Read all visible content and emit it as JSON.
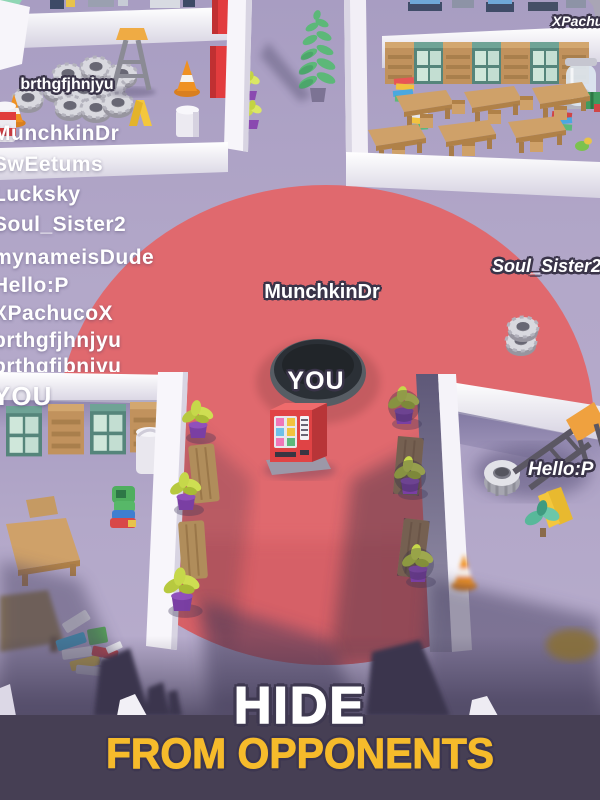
{
  "game": {
    "banner": {
      "title": "HIDE",
      "subtitle": "FROM OPPONENTS"
    },
    "players": {
      "list": [
        "MunchkinDr",
        "SwEetums",
        "Lucksky",
        "Soul_Sister2",
        "mynameisDude",
        "Hello:P",
        "XPachucoX",
        "brthgfjhnjyu",
        "brthgfjbnjyu",
        "YOU"
      ]
    },
    "world_labels": {
      "top_left_player": "brthgfjhnjyu",
      "hole_player": "MunchkinDr",
      "you": "YOU",
      "right_player": "Soul_Sister2",
      "top_right_player": "XPachucoX",
      "bottom_right_player": "Hello:P"
    },
    "colors": {
      "floor": "#b2a7c8",
      "zone_red": "#e0696e",
      "hole": "#2e3339",
      "wall": "#fbfafd",
      "banner_bg": "#463f54",
      "banner_title": "#ffffff",
      "banner_subtitle": "#f6bb2b"
    }
  }
}
